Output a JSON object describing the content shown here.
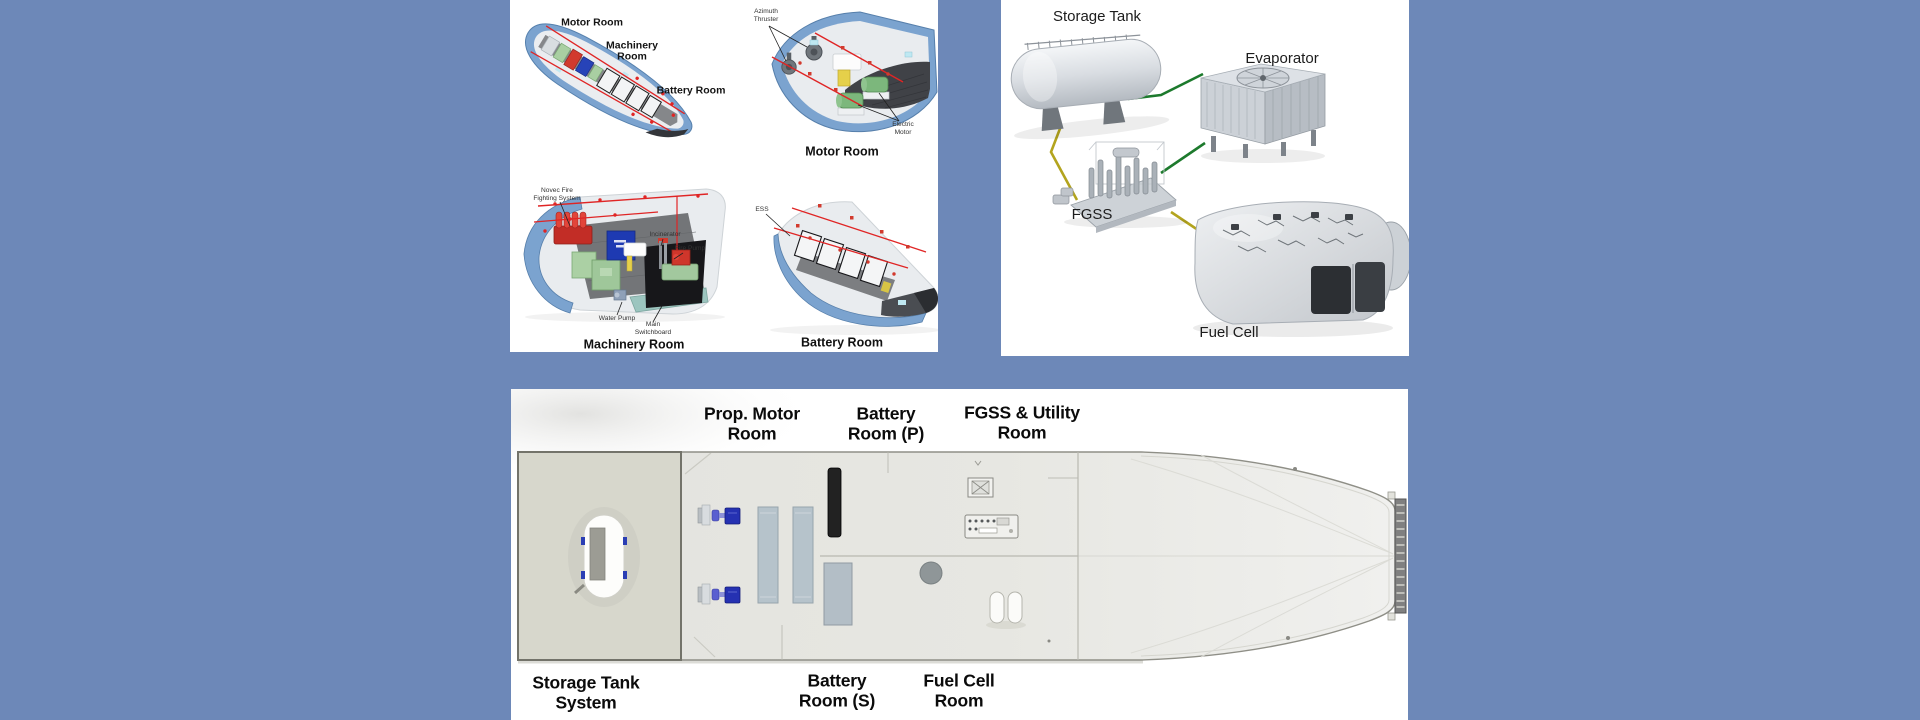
{
  "colors": {
    "background": "#6d88b8",
    "panel": "#ffffff",
    "pipe_red": "#e02525",
    "flow_green": "#1d7a2d",
    "flow_yellow": "#b3a41e",
    "hull_blue": "#7ba3cf"
  },
  "cutaways": {
    "overview": {
      "motor_room": "Motor Room",
      "machinery_room": "Machinery\nRoom",
      "battery_room": "Battery Room"
    },
    "motor_room": {
      "caption": "Motor Room",
      "azimuth_thruster": "Azimuth\nThruster",
      "electric_motor": "Electric\nMotor"
    },
    "machinery_room": {
      "caption": "Machinery Room",
      "novec": "Novec Fire\nFighting System",
      "incinerator": "Incinerator",
      "fire_pump": "Fire Pump",
      "water_pump": "Water Pump",
      "main_switchboard": "Main\nSwitchboard"
    },
    "battery_room": {
      "caption": "Battery Room",
      "ess": "ESS"
    }
  },
  "fgss_flow": {
    "storage_tank": "Storage Tank",
    "evaporator": "Evaporator",
    "fgss": "FGSS",
    "fuel_cell": "Fuel Cell"
  },
  "deck_plan": {
    "top": {
      "prop_motor": "Prop. Motor\nRoom",
      "battery_p": "Battery\nRoom (P)",
      "fgss_utility": "FGSS & Utility\nRoom"
    },
    "bottom": {
      "storage_tank_system": "Storage Tank\nSystem",
      "battery_s": "Battery\nRoom (S)",
      "fuel_cell_room": "Fuel Cell\nRoom"
    }
  }
}
